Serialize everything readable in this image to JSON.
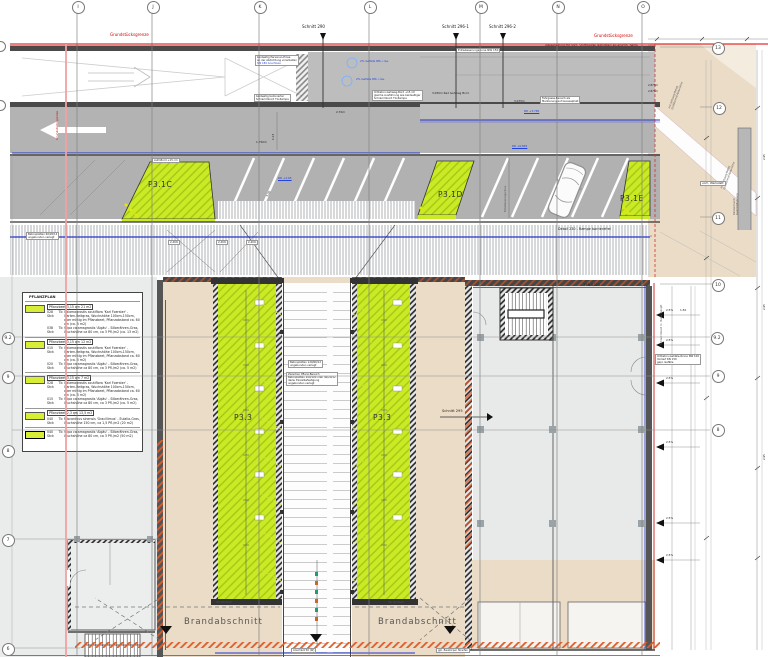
{
  "grid": {
    "cols": [
      "I",
      "J",
      "K",
      "L",
      "M",
      "N",
      "O"
    ],
    "rows_left": [
      "9.2",
      "9",
      "8",
      "7",
      "6"
    ],
    "rows_right": [
      "13",
      "12",
      "11",
      "10",
      "9.2",
      "9",
      "8"
    ]
  },
  "boundary": {
    "label": "Grundstücksgrenze",
    "water_note": "Wasserleitung mit vorh. Stützbauten Naturstein als ersichtl. Bema"
  },
  "sections": {
    "s290": "Schnitt 290",
    "s296_1": "Schnitt 296-1",
    "s296_2": "Schnitt 296-2",
    "s295": "Schnitt 295"
  },
  "areas": {
    "p31c": "P3.1C",
    "p31d": "P3.1D",
    "p31e": "P3.1E",
    "p33": "P3.3",
    "brand": "Brandabschnitt",
    "uk_vordach": "UK Vordach",
    "werkstatt": "vorh. Werkstatt",
    "ffb": "FFB 4,110"
  },
  "levels": {
    "rd1": "RD +3,765",
    "rd2": "RD +0,845",
    "rd3": "RD +2,65"
  },
  "notes": {
    "person1": "beidseitig Personen-Einse",
    "person2": "an der Abdichtung vorarbeiten",
    "person3": "SW 180 Anschluss",
    "schramm1": "beidseitig betonierter",
    "schramm2": "Schrammbord TG-Rampe",
    "bord1": "Ortbeton-Gehweg-Bord +15 cm",
    "bord2": "gleiche Ausführung wie beidseitiger",
    "bord3": "Schrammbord TG-Rampe",
    "rinne150": "Entwässerungsrinne NW 150",
    "fahrgasse1": "Fahrgasse-Bereich als",
    "fahrgasse2": "Markierung auf Gussasphalt",
    "gefaelle": "2% Gefälle Rfb. i.Ge.",
    "beton60a": "Betonplatten 60/20/12",
    "beton60b": "ungebunden verlegt",
    "beton120a": "Betonplatten 120/60/12",
    "beton120b": "ungebunden verlegt",
    "zw1": "Zwischen Pflanz-Bereich",
    "zw2": "Betonplatten 200/100 oder 40/20/12",
    "zw3": "dazw. Einzelbefestigung",
    "zw4": "ungebunden verlegt",
    "rinne100a": "Ortbeton-Gehälle-Rinne NW 100",
    "rinne100b": "Vorlauf DN 150",
    "rinne100c": "gepl. Gefälle",
    "gehweg1": "mit Gehweg-Belag",
    "gehweg2": "Großformat-Naturstein",
    "rinde1": "Rindenmulch",
    "rinde2": "Gehölzpflanzung",
    "aufz": "Aufz.Bord +15 cm",
    "detail230": "Detail 230 - Rampe barrierefrei",
    "anschluss": "Anschluß 50 (W)",
    "baukoerper": "gpl. Baukörper Streifen",
    "schrammbord_rot": "Schrammbord m. Natursteinpfl.",
    "entw_rot": "Entwässerungsrinne"
  },
  "dims": {
    "d1750": "1,750m",
    "d3050": "3,050m Rad Gehweg Bord",
    "d3075": "3,075m",
    "d270": "2,70m",
    "d240": "2,40m",
    "d123": "1,23",
    "d500": "5,00",
    "d2875": "2,875m",
    "d295": "2,95",
    "slope": "2,5%",
    "d150": "1,50"
  },
  "legend": {
    "title": "PFLANZPLAN",
    "entries": [
      {
        "header": "Pflanzbeet 3,15 qm  21 m2",
        "qty1": "028 Stck",
        "tag1": "Tb",
        "desc1": "Calamagrostis acutiflora 'Karl Foerster' - Garten-Reitgras, Wuchshöhe 100cm-150cm, aber mittig im Pflanzbeet, Pflanzabstand ca. 60 cm (ca. 5 m2)",
        "qty2": "038 Stck",
        "tag2": "Tb",
        "desc2": "Stipa calamagrostis 'Algäu' - Silberähren-Gras, Wuchshöhe ca 80 cm, ca 3 Pfl./m2 (ca. 13 m2)"
      },
      {
        "header": "Pflanzbeet 3,15 qm  12 m2",
        "qty1": "010 Stck",
        "tag1": "Tb",
        "desc1": "Calamagrostis acutiflora 'Karl Foerster' - Garten-Reitgras, Wuchshöhe 100cm-150cm, aber mittig im Pflanzbeet, Pflanzabstand ca. 60 cm (ca. 5 m2)",
        "qty2": "020 Stck",
        "tag2": "Tb",
        "desc2": "Stipa calamagrostis 'Algäu' - Silberähren-Gras, Wuchshöhe ca 80 cm, ca 3 Pfl./m2 (ca. 5 m2)"
      },
      {
        "header": "Pflanzbeet 3,15 qm  7 m2",
        "qty1": "028 Stck",
        "tag1": "Tb",
        "desc1": "Calamagrostis acutiflora 'Karl Foerster' - Garten-Reitgras, Wuchshöhe 100cm-150cm, aber mittig im Pflanzbeet, Pflanzabstand ca. 60 cm (ca. 5 m2)",
        "qty2": "015 Stck",
        "tag2": "Tb",
        "desc2": "Stipa calamagrostis 'Algäu' - Silberähren-Gras, Wuchshöhe ca 80 cm, ca 3 Pfl./m2 (ca. 5 m2)"
      },
      {
        "header": "Pflanzbeet 2,3 qm  13,5 m2",
        "qty1": "040 Stck",
        "tag1": "Tb",
        "desc1": "Miscanthus sinensis 'Gracillimus' - Eulalia-Gras, Wuchshöhe 150 cm, ca 1,5 Pfl./m2 (20 m2)"
      },
      {
        "header": "",
        "qty1": "040 Stck",
        "tag1": "Tb",
        "desc1": "Stipa calamagrostis 'Algäu' - Silberähren-Gras, Wuchshöhe ca 80 cm, ca 3 Pfl./m2 (50 m2)"
      }
    ]
  },
  "colors": {
    "planting_green": "#c9ea25",
    "deck_gray": "#bdbdbd",
    "road_gray": "#b1b1b1",
    "beige": "#eadcc6",
    "boundary_red": "#e23030",
    "line_blue": "#2233cc",
    "fire_orange": "#e05a28"
  }
}
